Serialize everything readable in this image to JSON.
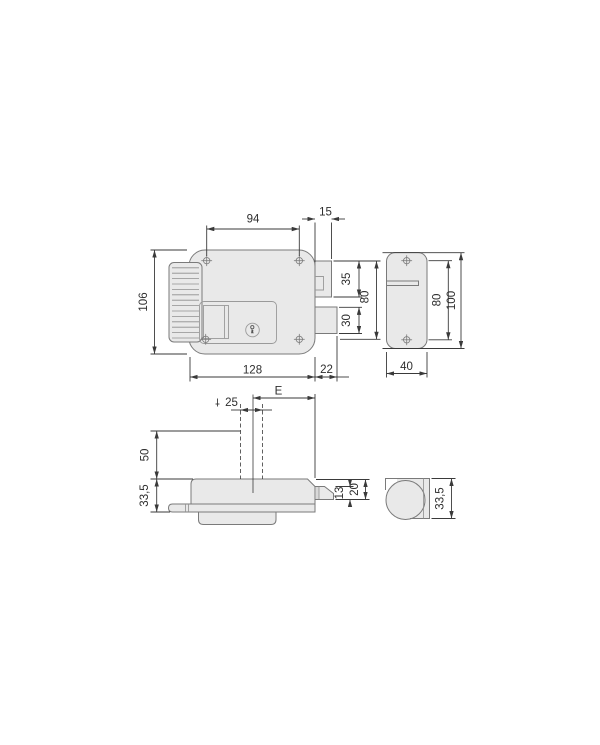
{
  "drawing": {
    "type": "technical-dimension-drawing",
    "subject": "electric rim lock with strike plate",
    "colors": {
      "background": "#ffffff",
      "part_fill": "#e9e9e9",
      "part_outline": "#7a7a7a",
      "dimension_lines": "#3a3a3a",
      "dimension_text": "#2e2e2e"
    },
    "views": {
      "front": {
        "dims": {
          "hole_spacing": "94",
          "latch_protrusion": "15",
          "height": "106",
          "width": "128",
          "deadbolt_protrusion": "22",
          "latch_height": "35",
          "deadbolt_height": "30",
          "span": "80"
        }
      },
      "strike_front": {
        "dims": {
          "hole_spacing": "80",
          "height": "100",
          "width": "40"
        }
      },
      "top": {
        "dims": {
          "backset": "E",
          "cylinder_width": "25",
          "stem_length": "50",
          "body_depth": "33,5",
          "latch_depth": "13",
          "latch_total_depth": "20"
        }
      },
      "strike_top": {
        "dims": {
          "depth": "33,5"
        }
      }
    }
  }
}
